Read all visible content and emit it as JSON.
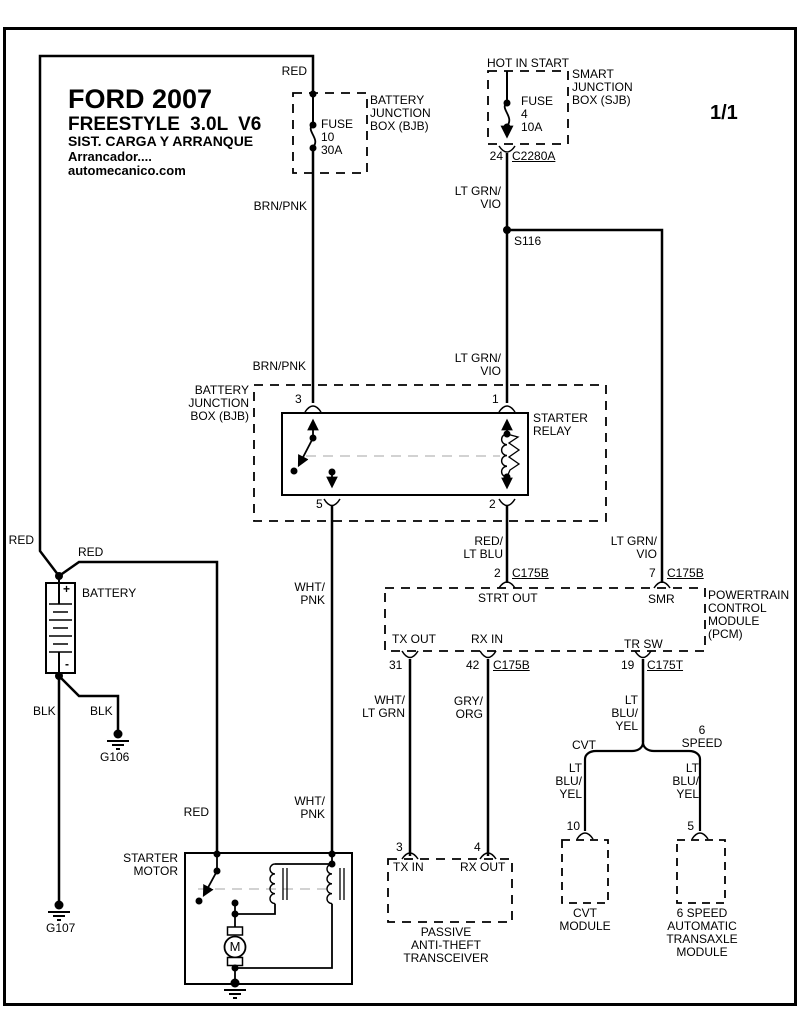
{
  "header": {
    "title1": "FORD 2007",
    "title2": "FREESTYLE 3.0L V6",
    "title3": "SIST. CARGA Y ARRANQUE",
    "title4": "Arrancador....",
    "title5": "automecanico.com",
    "page": "1/1"
  },
  "sjb": {
    "hot_label": "HOT IN START",
    "fuse": "FUSE\n4\n10A",
    "box_label": "SMART\nJUNCTION\nBOX (SJB)",
    "pin": "24",
    "connector": "C2280A"
  },
  "bjb_fuse": {
    "fuse": "FUSE\n10\n30A",
    "box_label": "BATTERY\nJUNCTION\nBOX (BJB)"
  },
  "splice": {
    "id": "S116"
  },
  "relay": {
    "box_label": "BATTERY\nJUNCTION\nBOX (BJB)",
    "name": "STARTER\nRELAY",
    "pin3": "3",
    "pin1": "1",
    "pin5": "5",
    "pin2": "2"
  },
  "battery": {
    "label": "BATTERY",
    "plus": "+",
    "minus": "-"
  },
  "grounds": {
    "g106": "G106",
    "g107": "G107"
  },
  "starter": {
    "name": "STARTER\nMOTOR",
    "motor_letter": "M"
  },
  "pcm": {
    "pin2": "2",
    "pin2_conn": "C175B",
    "pin7": "7",
    "pin7_conn": "C175B",
    "strt_out": "STRT OUT",
    "smr": "SMR",
    "tx_out": "TX OUT",
    "rx_in": "RX IN",
    "tr_sw": "TR SW",
    "pin31": "31",
    "pin42": "42",
    "pin42_conn": "C175B",
    "pin19": "19",
    "pin19_conn": "C175T",
    "name": "POWERTRAIN\nCONTROL\nMODULE\n(PCM)"
  },
  "pats": {
    "pin3": "3",
    "pin4": "4",
    "tx_in": "TX IN",
    "rx_out": "RX OUT",
    "name": "PASSIVE\nANTI-THEFT\nTRANSCEIVER"
  },
  "cvt": {
    "branch_label": "CVT",
    "pin": "10",
    "name": "CVT\nMODULE"
  },
  "sixspeed": {
    "branch_label": "6\nSPEED",
    "pin": "5",
    "name": "6 SPEED\nAUTOMATIC\nTRANSAXLE\nMODULE"
  },
  "wire_labels": {
    "red_top": "RED",
    "brn_pnk_upper": "BRN/PNK",
    "brn_pnk_lower": "BRN/PNK",
    "lt_grn_vio_top": "LT GRN/\nVIO",
    "lt_grn_vio_mid": "LT GRN/\nVIO",
    "lt_grn_vio_pcm": "LT GRN/\nVIO",
    "red_batt_left": "RED",
    "red_batt_right": "RED",
    "red_starter": "RED",
    "blk_g107": "BLK",
    "blk_g106": "BLK",
    "wht_pnk_upper": "WHT/\nPNK",
    "wht_pnk_lower": "WHT/\nPNK",
    "red_lt_blu": "RED/\nLT BLU",
    "wht_lt_grn": "WHT/\nLT GRN",
    "gry_org": "GRY/\nORG",
    "lt_blu_yel_main": "LT\nBLU/\nYEL",
    "lt_blu_yel_cvt": "LT\nBLU/\nYEL",
    "lt_blu_yel_6sp": "LT\nBLU/\nYEL"
  },
  "colors": {
    "wire": "#000000",
    "phantom": "#c3c3c3",
    "background": "#ffffff"
  }
}
